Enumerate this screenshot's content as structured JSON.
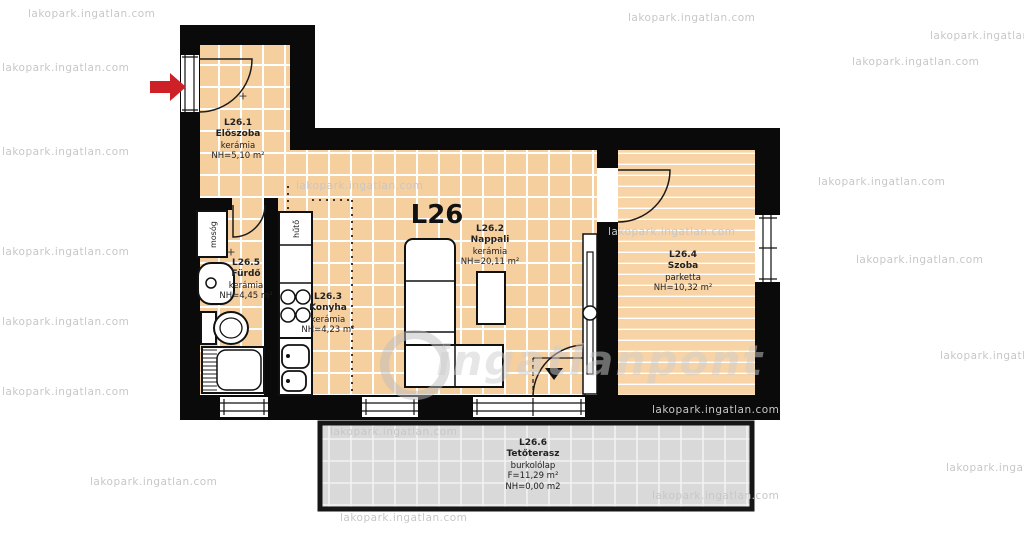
{
  "watermark": {
    "tile_text": "lakopark.ingatlan.com",
    "big_text": "ingatlanpont"
  },
  "plan": {
    "unit_label": "L26",
    "plus_mark": "+",
    "rooms": [
      {
        "id": "L26.1",
        "name": "Előszoba",
        "floor": "kerámia",
        "area": "NH=5,10 m²"
      },
      {
        "id": "L26.2",
        "name": "Nappali",
        "floor": "kerámia",
        "area": "NH=20,11 m²"
      },
      {
        "id": "L26.3",
        "name": "Konyha",
        "floor": "kerámia",
        "area": "NH=4,23 m²"
      },
      {
        "id": "L26.4",
        "name": "Szoba",
        "floor": "parketta",
        "area": "NH=10,32 m²"
      },
      {
        "id": "L26.5",
        "name": "Fürdő",
        "floor": "kerámia",
        "area": "NH=4,45 m²"
      },
      {
        "id": "L26.6",
        "name": "Tetőterasz",
        "floor": "burkolólap",
        "area_f": "F=11,29 m²",
        "area": "NH=0,00 m2"
      }
    ],
    "fixtures": {
      "washing_machine": "mosóg",
      "fridge": "hűtő"
    },
    "colors": {
      "wall": "#0a0a0a",
      "ceramic_floor": "#f6cf9e",
      "parquet_floor": "#f7d3a5",
      "terrace_floor": "#d9d9d9",
      "grid_line": "#ffffff",
      "entrance_arrow": "#ce2127"
    }
  }
}
